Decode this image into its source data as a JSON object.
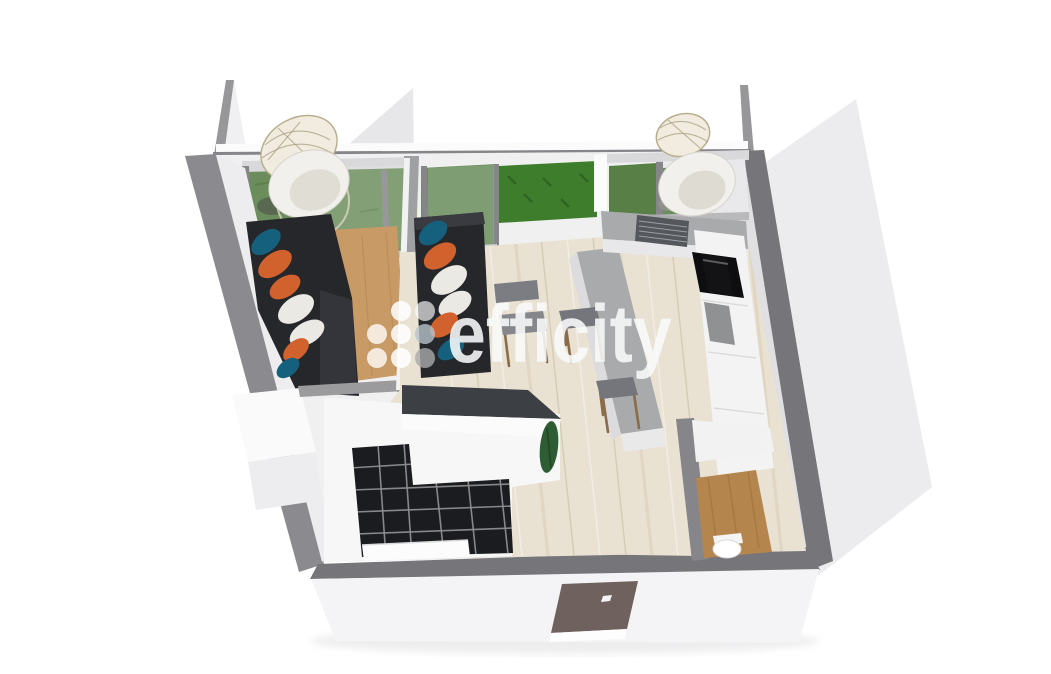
{
  "watermark": {
    "text": "efficity"
  },
  "colors": {
    "wall_band": "#75757a",
    "wall_light": "#8b8b8f",
    "wall_mid": "#85858a",
    "ext_face": "#ececee",
    "ext_top": "#fbfbfc",
    "south_face": "#f4f4f6",
    "interior": "#f0f0f1",
    "floor_oak": "#e9e2d3",
    "floor_tan": "#c79a66",
    "floor_wc": "#b5854e",
    "tiles": "#1b1c20",
    "grout": "#8e8e90",
    "hedge": "#3e7d2b",
    "grass": "#6b8d5c",
    "grass2": "#587f46",
    "sofa": "#26272b",
    "pillow_teal": "#15607c",
    "pillow_orange": "#d2622d",
    "pillow_white": "#ebe9e4",
    "counter": "#a9aaac",
    "counter_face": "#e8e8ea",
    "sink": "#54575b",
    "hob": "#0e0e10",
    "cabinet": "#f3f3f4",
    "oven": "#131316",
    "micro": "#8f9193",
    "stool": "#74767b",
    "wood_leg": "#8a6b4a",
    "door": "#6f615d",
    "dark_bar": "#3c3f43",
    "plant": "#2f5d33",
    "rattan_fill": "#f1ecdf",
    "rattan_stroke": "#b8ae8e",
    "chair_body": "#f1f0ec",
    "white": "#fbfbfc",
    "wm_text": "rgba(248,250,251,0.88)"
  }
}
